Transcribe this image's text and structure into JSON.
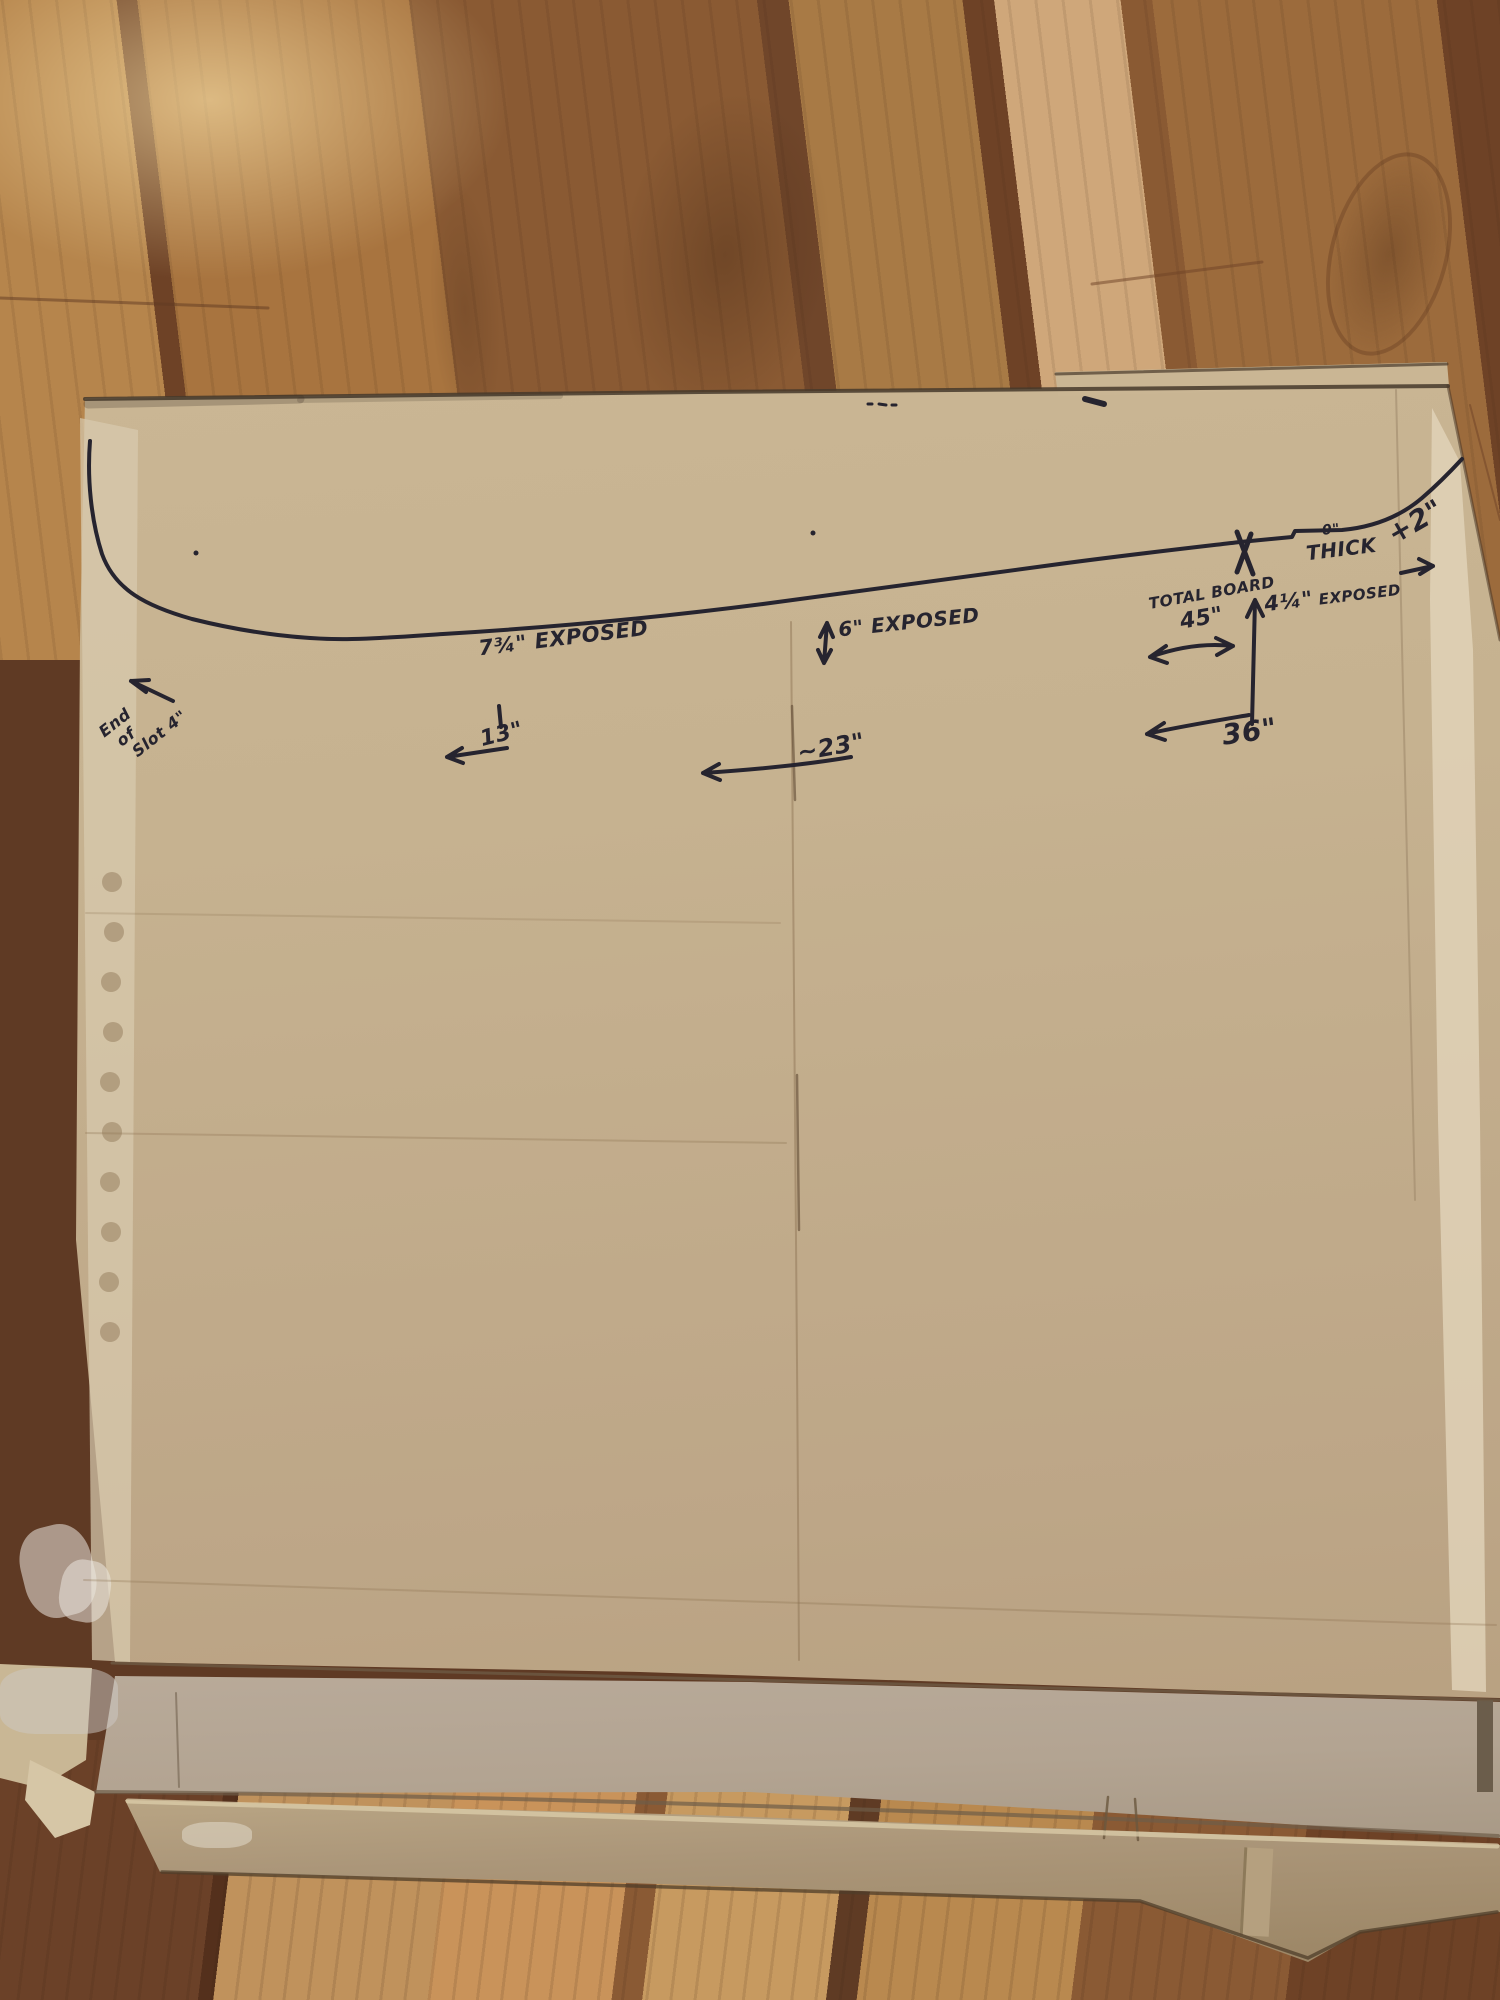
{
  "annotations": {
    "exposed_7_3_4": "7¾\" EXPOSED",
    "tick_13": "13\"",
    "exposed_6": "6\" EXPOSED",
    "approx_23": "~23\"",
    "total_board_line1": "TOTAL BOARD",
    "total_board_line2": "45\"",
    "exposed_4_1_4_value": "4¼\"",
    "exposed_4_1_4_label": "EXPOSED",
    "dim_36": "36\"",
    "thick_value": "0\"",
    "thick_label": "THICK",
    "plus_2": "+2\"",
    "end_of_slot_line1": "End",
    "end_of_slot_line2": "of",
    "end_of_slot_line3": "Slot 4\""
  },
  "colors": {
    "marker_ink": "#26242f",
    "cardboard": "#c4b08e",
    "cardboard_flap_gray": "#b3a492",
    "floor_dark": "#5f3a24",
    "floor_light": "#c99a62"
  }
}
